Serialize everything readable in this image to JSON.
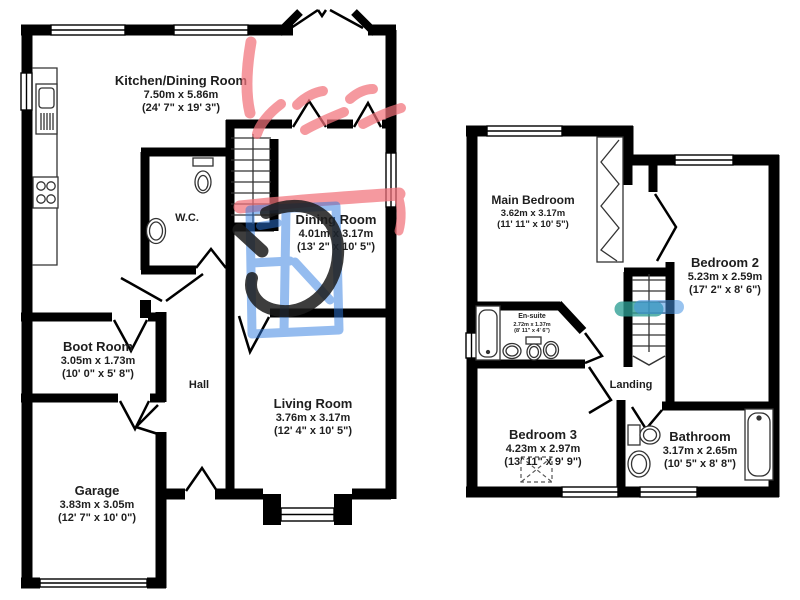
{
  "ground_floor": {
    "kitchen": {
      "name": "Kitchen/Dining Room",
      "metric": "7.50m x 5.86m",
      "imperial": "(24' 7\" x 19' 3\")"
    },
    "wc": {
      "name": "W.C."
    },
    "dining": {
      "name": "Dining Room",
      "metric": "4.01m x 3.17m",
      "imperial": "(13' 2\" x 10' 5\")"
    },
    "boot": {
      "name": "Boot Room",
      "metric": "3.05m x 1.73m",
      "imperial": "(10' 0\" x 5' 8\")"
    },
    "hall": {
      "name": "Hall"
    },
    "living": {
      "name": "Living Room",
      "metric": "3.76m x 3.17m",
      "imperial": "(12' 4\" x 10' 5\")"
    },
    "garage": {
      "name": "Garage",
      "metric": "3.83m x 3.05m",
      "imperial": "(12' 7\" x 10' 0\")"
    }
  },
  "first_floor": {
    "main_bedroom": {
      "name": "Main Bedroom",
      "metric": "3.62m x 3.17m",
      "imperial": "(11' 11\" x 10' 5\")"
    },
    "bedroom2": {
      "name": "Bedroom 2",
      "metric": "5.23m x 2.59m",
      "imperial": "(17' 2\" x 8' 6\")"
    },
    "ensuite": {
      "name": "En-suite",
      "metric": "2.72m x 1.37m",
      "imperial": "(8' 11\" x 4' 6\")"
    },
    "landing": {
      "name": "Landing"
    },
    "bedroom3": {
      "name": "Bedroom 3",
      "metric": "4.23m x 2.97m",
      "imperial": "(13' 11\" x 9' 9\")"
    },
    "bathroom": {
      "name": "Bathroom",
      "metric": "3.17m x 2.65m",
      "imperial": "(10' 5\" x 8' 8\")"
    }
  },
  "annotations": {
    "colors": {
      "red": "#f2727b",
      "blue": "#2e7be0",
      "black": "#1c1c1c",
      "teal": "#2d9e93",
      "lightblue": "#4492e2"
    }
  }
}
